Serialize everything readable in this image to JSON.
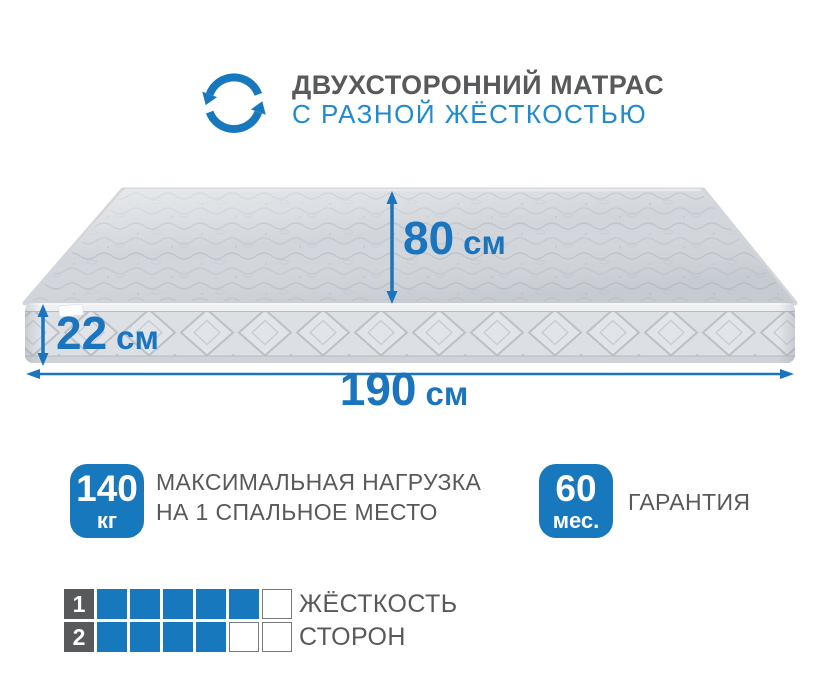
{
  "header": {
    "icon": "flip-rotate-arrows",
    "title": "ДВУХСТОРОННИЙ МАТРАС",
    "subtitle": "С РАЗНОЙ ЖЁСТКОСТЬЮ"
  },
  "mattress": {
    "dimensions": {
      "bed_length": {
        "value": "80",
        "unit": "см"
      },
      "height": {
        "value": "22",
        "unit": "см"
      },
      "width": {
        "value": "190",
        "unit": "см"
      }
    }
  },
  "specs": {
    "max_load": {
      "badge_value": "140",
      "badge_unit": "кг",
      "line1": "МАКСИМАЛЬНАЯ НАГРУЗКА",
      "line2": "НА 1 СПАЛЬНОЕ МЕСТО"
    },
    "warranty": {
      "badge_value": "60",
      "badge_unit": "мес.",
      "line1": "ГАРАНТИЯ"
    }
  },
  "firmness": {
    "scale_max": 6,
    "rows": [
      {
        "side": "1",
        "filled": 5
      },
      {
        "side": "2",
        "filled": 4
      }
    ],
    "label_line1": "ЖЁСТКОСТЬ",
    "label_line2": "СТОРОН"
  },
  "colors": {
    "accent_blue": "#1878BE",
    "dimension_blue": "#1B74BE",
    "subtitle_blue": "#1E8AD2",
    "text_gray": "#58595B",
    "mattress_top": "#D2D6DB",
    "mattress_side": "#DCDFE3"
  }
}
